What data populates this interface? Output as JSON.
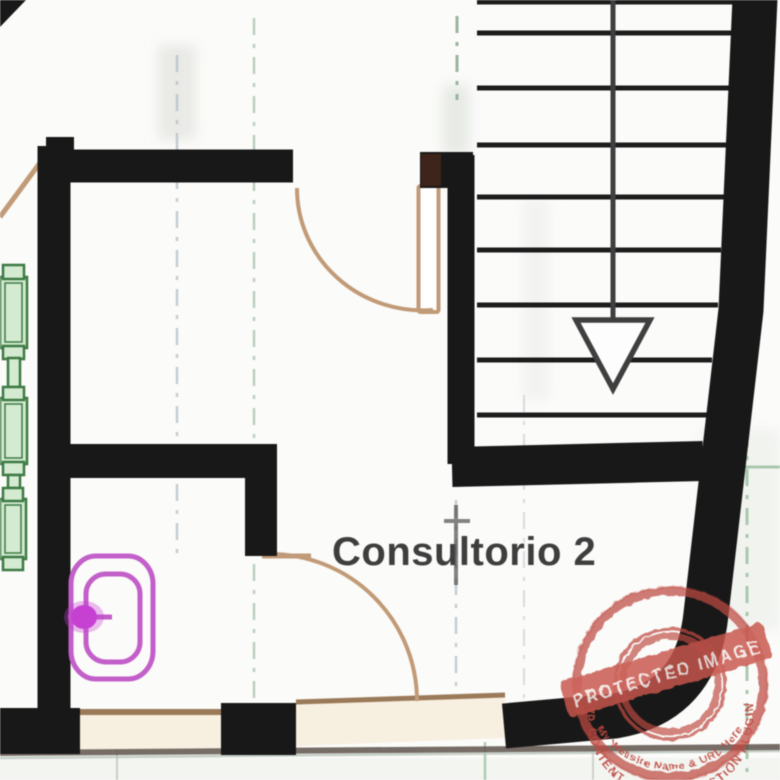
{
  "plan": {
    "room_label": "Consultorio 2",
    "stair": {
      "tread_count": 9,
      "direction_icon": "arrow-down-icon"
    },
    "fixtures": {
      "toilet_icon": "toilet-top-view-icon",
      "cabinet_count": 3
    },
    "colors": {
      "wall": "#181818",
      "wall_accent": "#3f241b",
      "tread": "#1c1c1c",
      "arrow": "#3f3f3f",
      "door_swing": "#c29a76",
      "window_fill": "#f7efe0",
      "window_line": "#9b7a58",
      "base_line": "#5f554c",
      "cabinet_fill": "#d4ebd2",
      "cabinet_stroke": "#3c7a42",
      "toilet": "#c45ecb",
      "toilet_blob": "#c83fd4",
      "label_text": "#3e3e3e",
      "gridline_gray": "#b6c1c7",
      "gridline_green": "#9cbfa1",
      "gridline_dark": "#4f4f4f"
    }
  },
  "watermark": {
    "arc_top_text": "WP CONTENT COPY PROTECTION PLUGIN",
    "banner_text": "PROTECTED IMAGE",
    "arc_bottom_text": "My Website Name & URL Here",
    "color": "#bf4a41",
    "banner_color": "#c9554b"
  }
}
